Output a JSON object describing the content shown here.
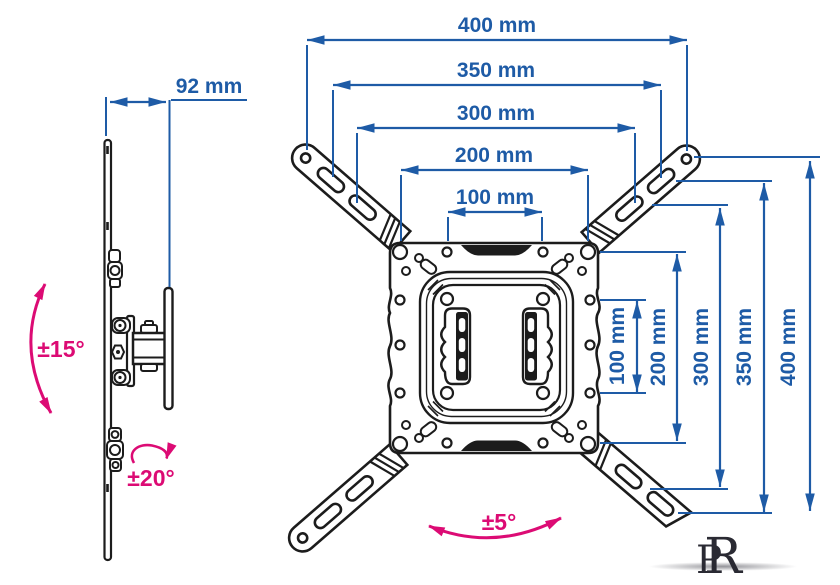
{
  "diagram": {
    "side_view": {
      "depth_dim": "92 mm",
      "tilt_range": "±15°",
      "swivel_range": "±20°"
    },
    "front_view": {
      "horizontal_dims": [
        "400 mm",
        "350 mm",
        "300 mm",
        "200 mm",
        "100 mm"
      ],
      "vertical_dims": [
        "100 mm",
        "200 mm",
        "300 mm",
        "350 mm",
        "400 mm"
      ],
      "rotation_range": "±5°"
    },
    "logo": {
      "letters": [
        "P",
        "R"
      ]
    },
    "colors": {
      "dimension_blue": "#1e5ba6",
      "accent_pink": "#dc0b74",
      "line_black": "#1c1c1c",
      "background": "#ffffff"
    }
  }
}
